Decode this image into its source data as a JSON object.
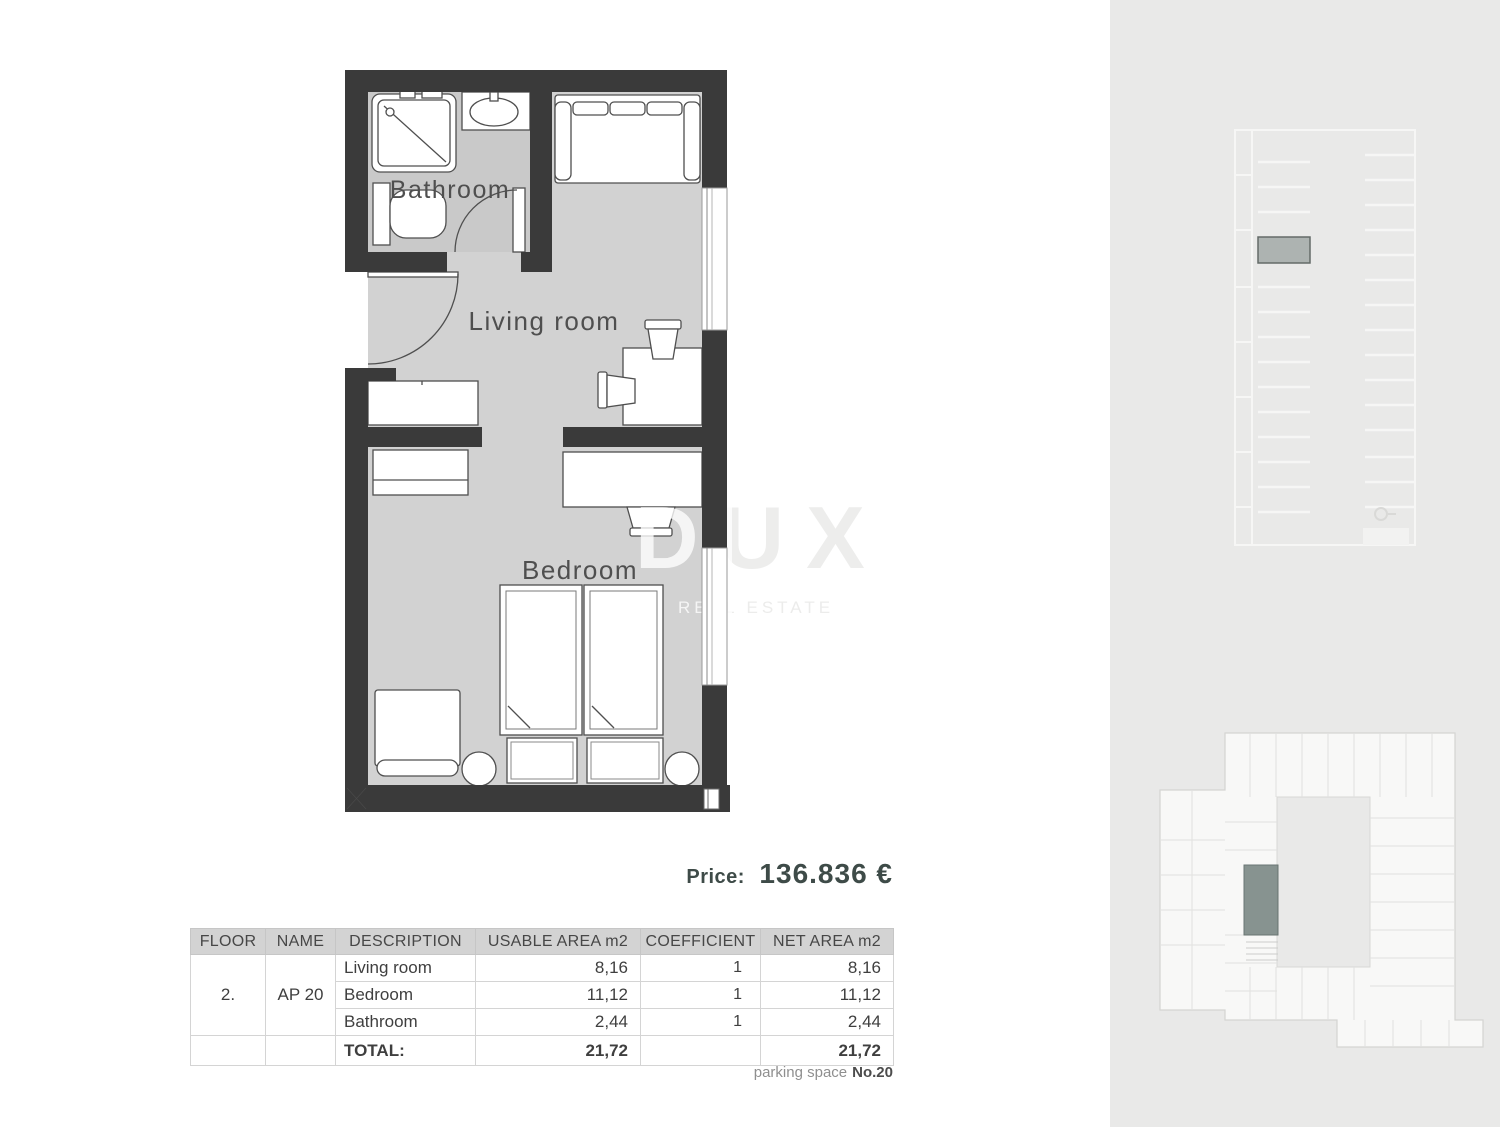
{
  "floor_plan": {
    "labels": {
      "bathroom": "Bathroom",
      "living_room": "Living room",
      "bedroom": "Bedroom"
    }
  },
  "watermark": {
    "title": "DUX",
    "subtitle": "REAL ESTATE"
  },
  "price": {
    "label": "Price:",
    "value": "136.836 €"
  },
  "area_table": {
    "headers": {
      "floor": "FLOOR",
      "name": "NAME",
      "description": "DESCRIPTION",
      "usable": "USABLE AREA m2",
      "coefficient": "COEFFICIENT",
      "net": "NET AREA m2"
    },
    "floor_value": "2.",
    "name_value": "AP 20",
    "rows": [
      {
        "description": "Living room",
        "usable": "8,16",
        "coefficient": "1",
        "net": "8,16"
      },
      {
        "description": "Bedroom",
        "usable": "11,12",
        "coefficient": "1",
        "net": "11,12"
      },
      {
        "description": "Bathroom",
        "usable": "2,44",
        "coefficient": "1",
        "net": "2,44"
      }
    ],
    "total": {
      "label": "TOTAL:",
      "usable": "21,72",
      "net": "21,72"
    }
  },
  "parking_note": {
    "label": "parking space",
    "value": "No.20"
  },
  "colors": {
    "wall": "#3a3a3a",
    "floor": "#d2d2d2",
    "bathroom_floor": "#c9c9c9",
    "panel_background": "#e9e9e8",
    "price_text": "#3e4b48",
    "highlighted_unit": "#7e8b88",
    "highlighted_parking_space": "#adb3b1"
  }
}
